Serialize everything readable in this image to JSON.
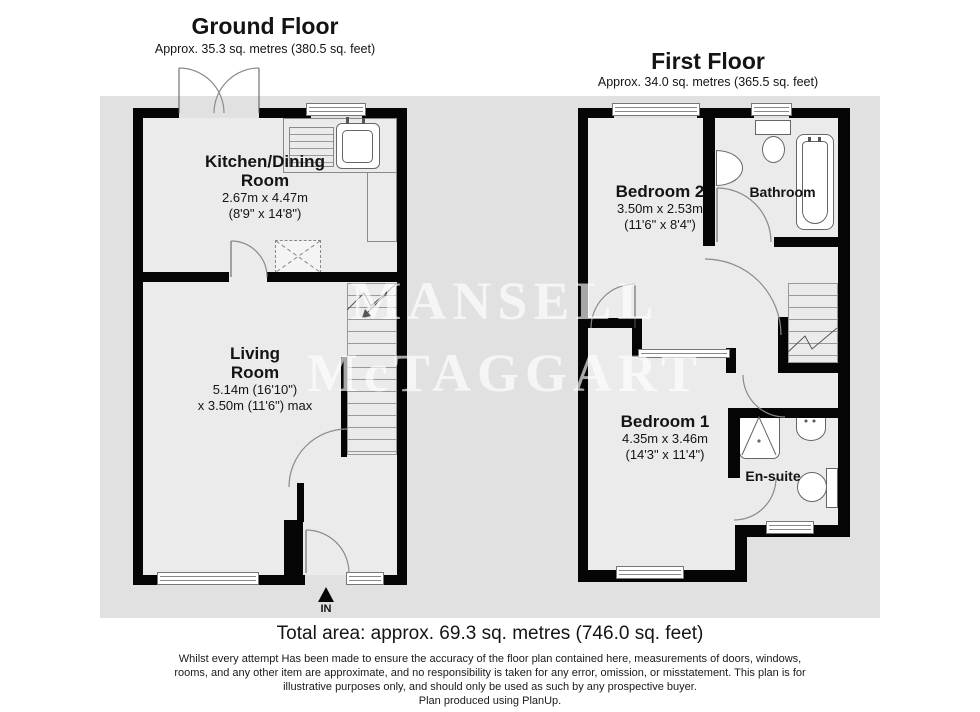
{
  "colors": {
    "plan_background": "#e1e1e1",
    "room_fill": "#ebebeb",
    "wall": "#050505",
    "line": "#888888",
    "watermark": "rgba(255,255,255,0.65)"
  },
  "watermark": {
    "line1": "MANSELL",
    "line2": "McTAGGART"
  },
  "ground_floor": {
    "title": "Ground Floor",
    "area": "Approx. 35.3 sq. metres (380.5 sq. feet)",
    "kitchen": {
      "name_line1": "Kitchen/Dining",
      "name_line2": "Room",
      "dims_metric": "2.67m x 4.47m",
      "dims_imperial": "(8'9\" x 14'8\")"
    },
    "living": {
      "name_line1": "Living",
      "name_line2": "Room",
      "dims_line1": "5.14m (16'10\")",
      "dims_line2": "x 3.50m (11'6\") max"
    },
    "entrance_label": "IN"
  },
  "first_floor": {
    "title": "First Floor",
    "area": "Approx. 34.0 sq. metres (365.5 sq. feet)",
    "bedroom2": {
      "name": "Bedroom 2",
      "dims_metric": "3.50m x 2.53m",
      "dims_imperial": "(11'6\" x 8'4\")"
    },
    "bathroom": {
      "name": "Bathroom"
    },
    "bedroom1": {
      "name": "Bedroom 1",
      "dims_metric": "4.35m x 3.46m",
      "dims_imperial": "(14'3\" x 11'4\")"
    },
    "ensuite": {
      "name": "En-suite"
    }
  },
  "footer": {
    "total_area": "Total area: approx. 69.3 sq. metres (746.0 sq. feet)",
    "disclaimer_lines": [
      "Whilst every attempt Has been made to ensure the accuracy of the floor plan contained here, measurements of doors, windows,",
      "rooms, and any other item are approximate, and no responsibility is taken for any error, omission, or misstatement. This plan is for",
      "illustrative purposes only, and should only be used as such by any prospective buyer.",
      "Plan produced using PlanUp."
    ]
  }
}
